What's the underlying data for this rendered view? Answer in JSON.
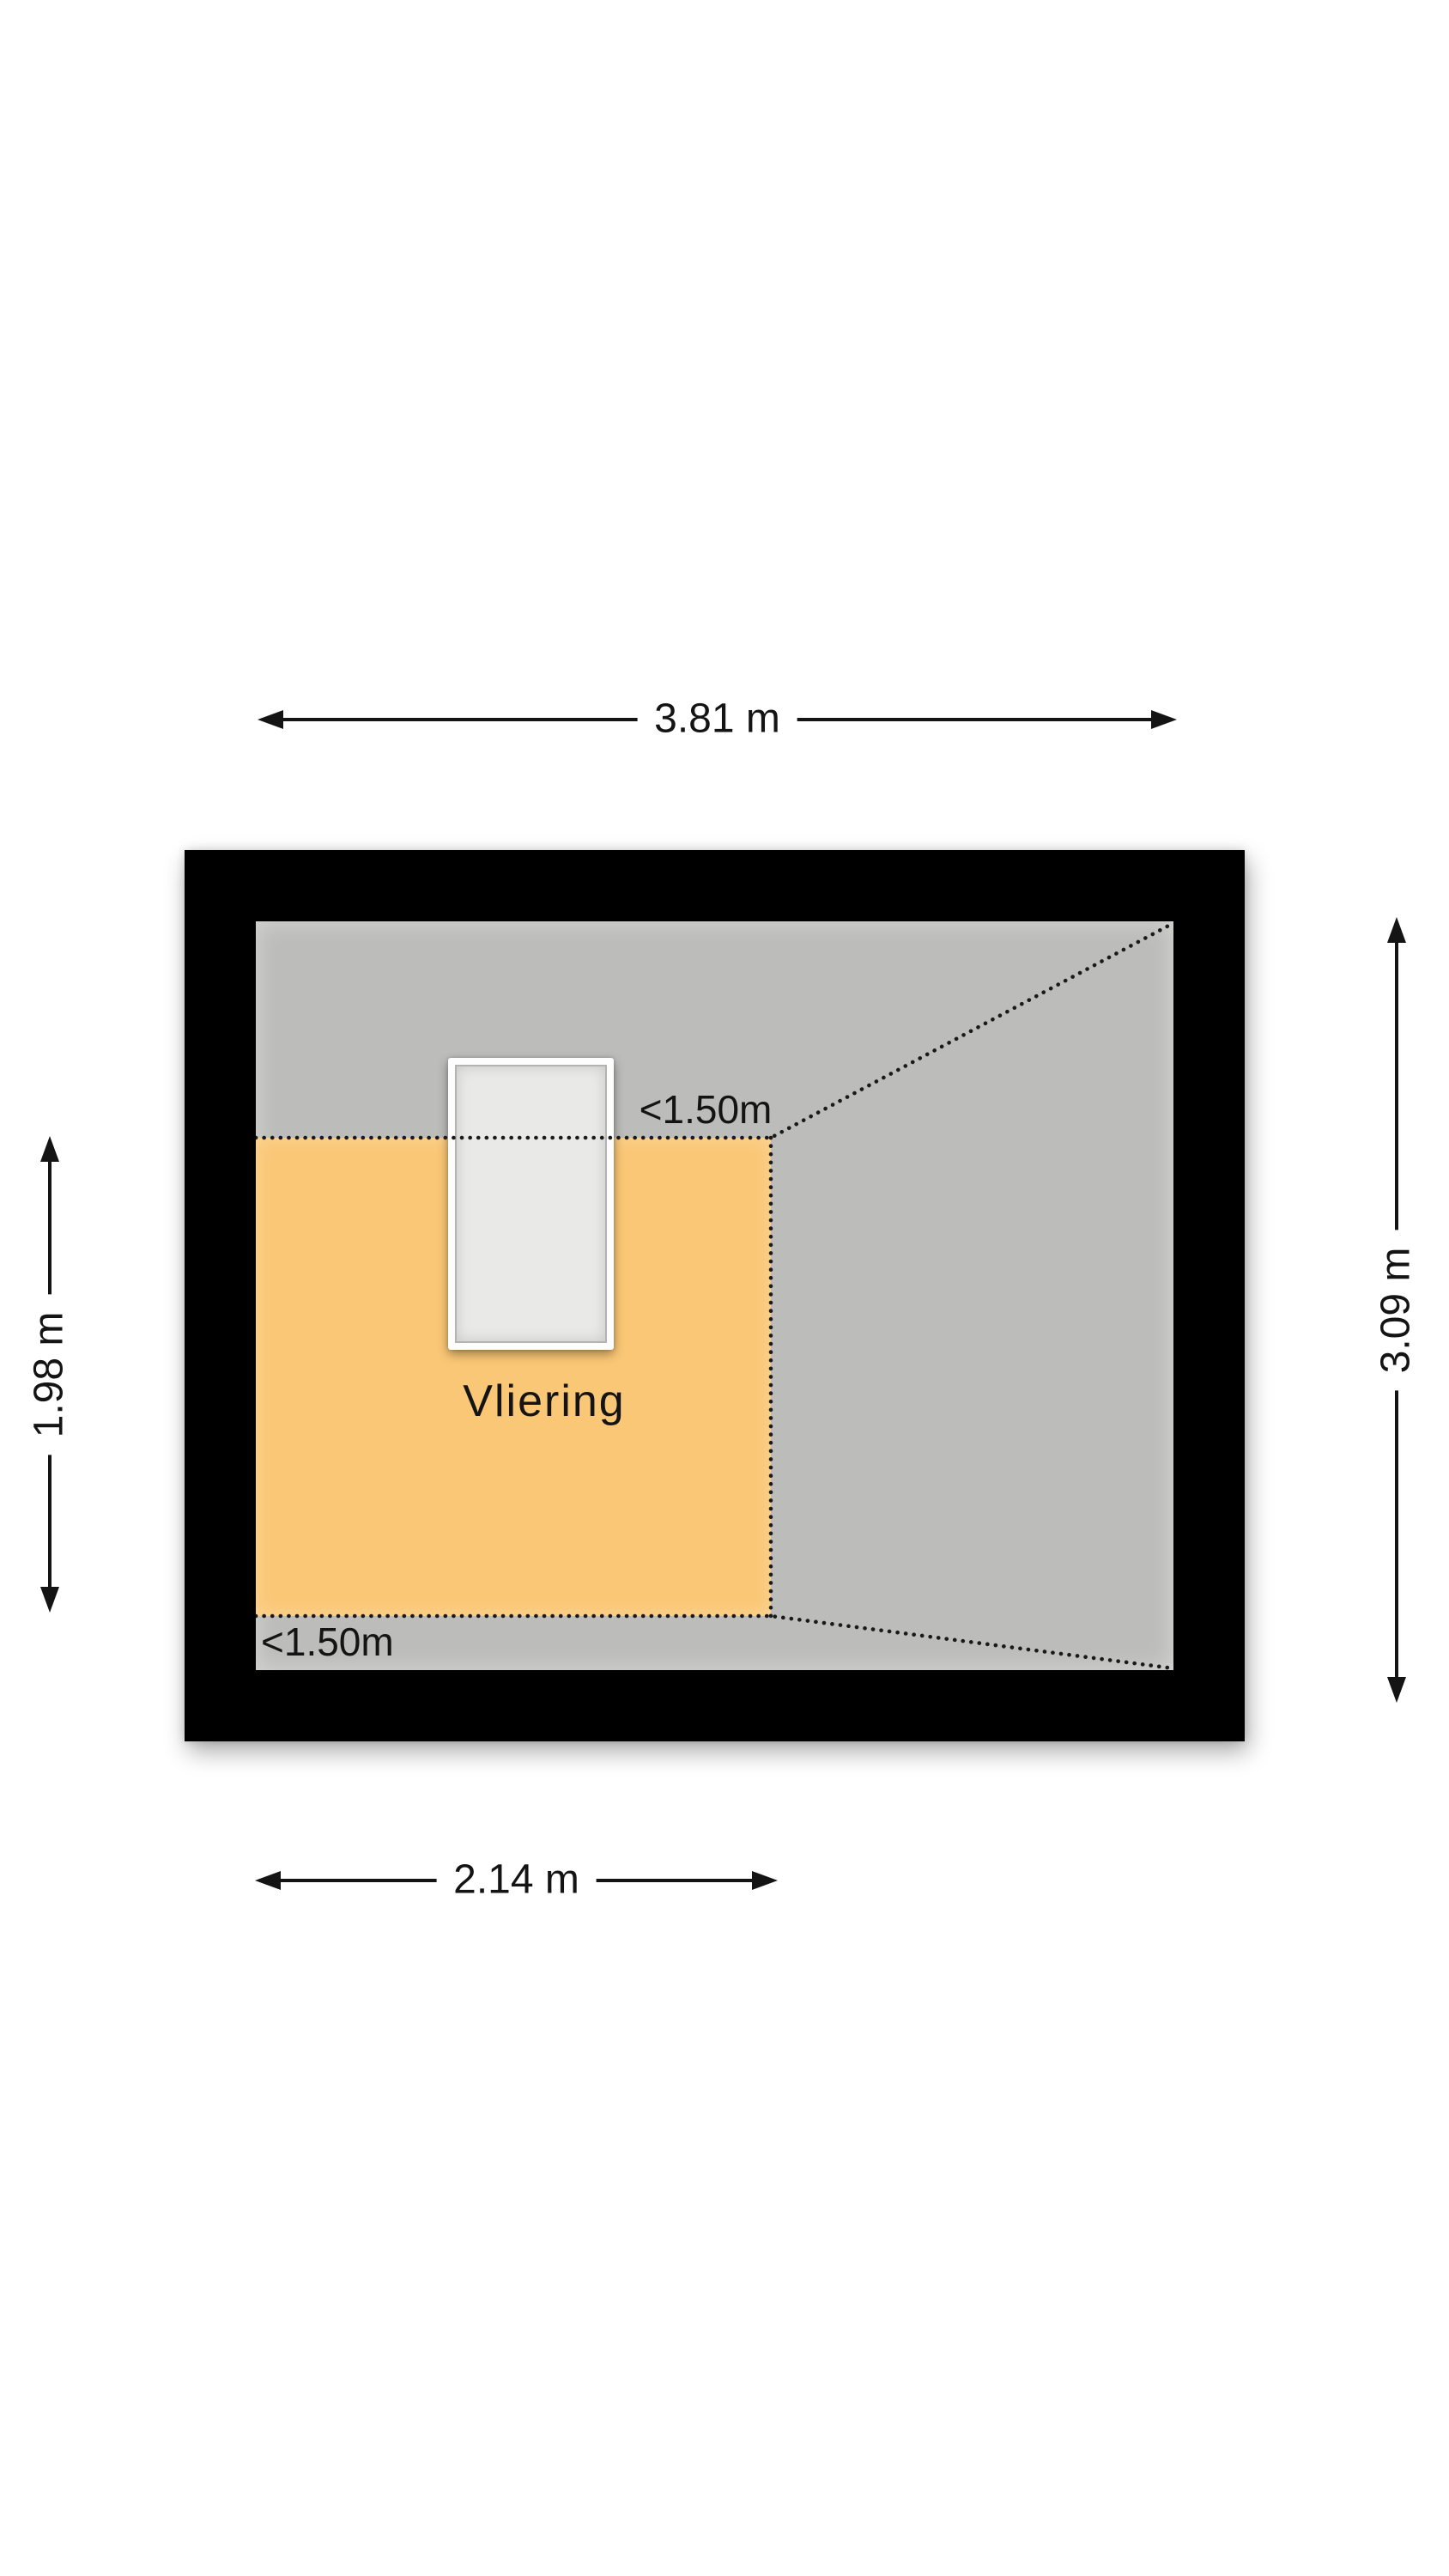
{
  "colors": {
    "background": "#ffffff",
    "wall": "#000000",
    "floor": "#bcbcba",
    "low-area": "#fac776",
    "stair-frame": "#fdfdfd",
    "stair-inner": "#e9e9e7",
    "stair-inner-line": "#b3b3b1",
    "dots": "#1a1a1a",
    "text": "#141414"
  },
  "room": {
    "name": "Vliering"
  },
  "dimensions": {
    "top": {
      "label": "3.81 m"
    },
    "bottom": {
      "label": "2.14 m"
    },
    "left": {
      "label": "1.98 m"
    },
    "right": {
      "label": "3.09 m"
    }
  },
  "height_markers": {
    "upper": "<1.50m",
    "lower": "<1.50m"
  }
}
